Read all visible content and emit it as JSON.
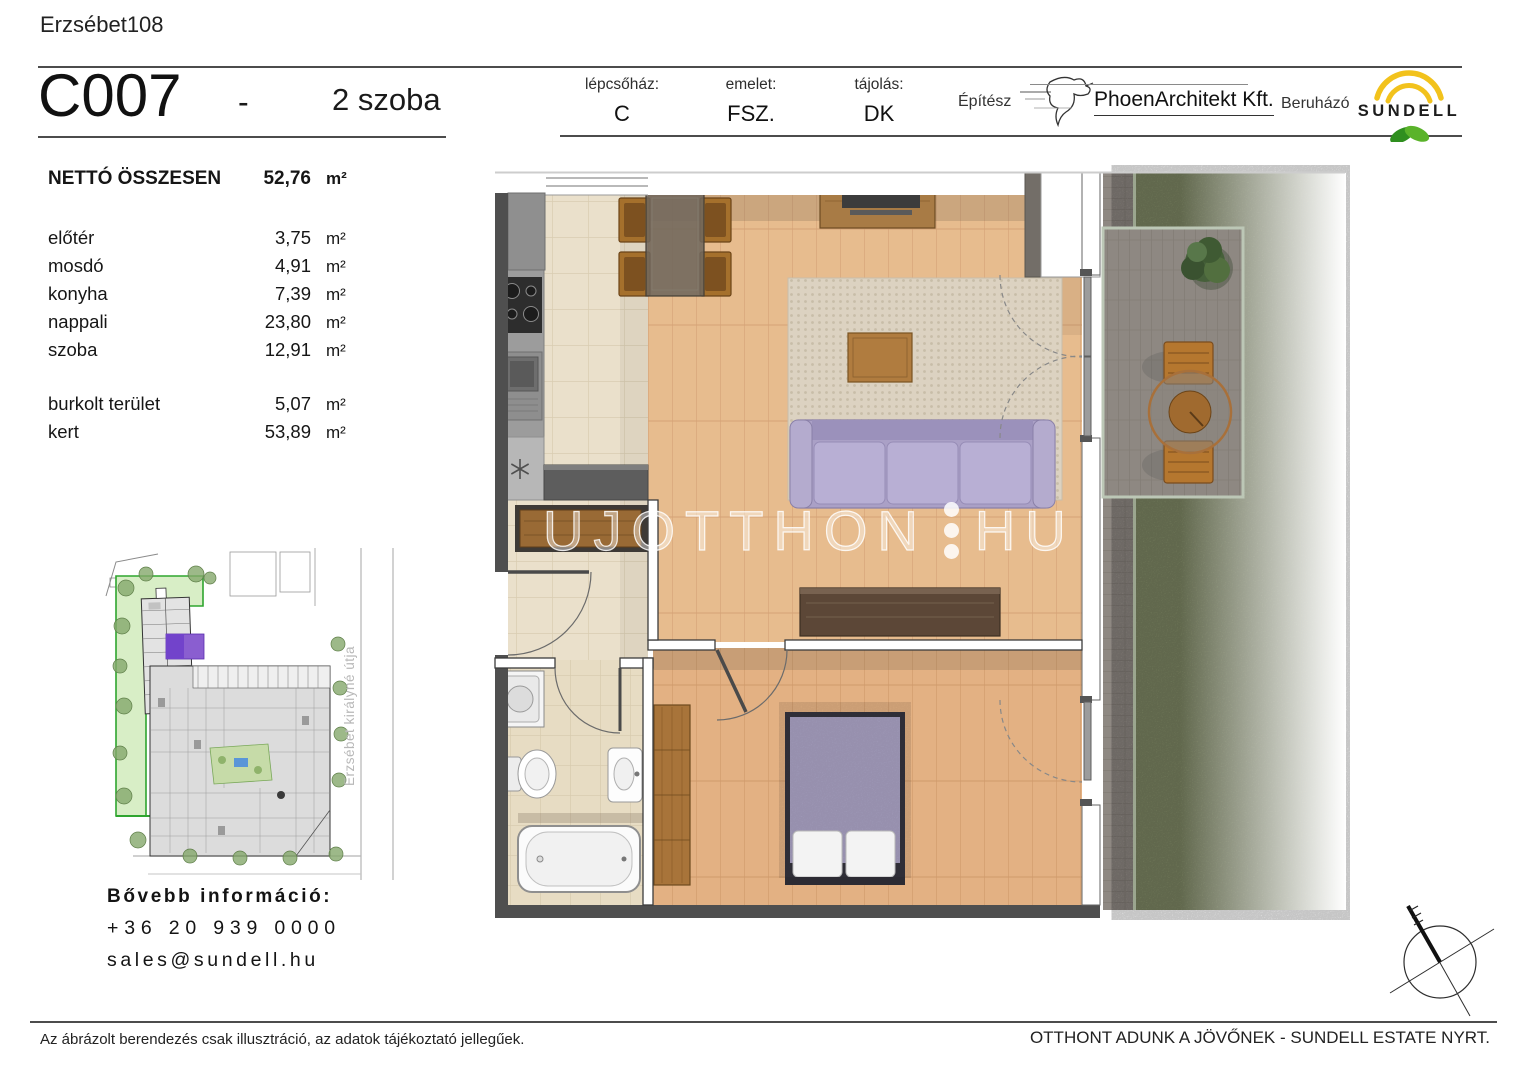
{
  "header": {
    "project_name": "Erzsébet108",
    "unit_id": "C007",
    "separator": "-",
    "room_count": "2 szoba",
    "fields": [
      {
        "label": "lépcsőház:",
        "value": "C"
      },
      {
        "label": "emelet:",
        "value": "FSZ."
      },
      {
        "label": "tájolás:",
        "value": "DK"
      }
    ],
    "architect_label": "Építész",
    "architect_name": "PhoenArchitekt Kft.",
    "developer_label": "Beruházó",
    "developer_name": "SUNDELL"
  },
  "area_table": {
    "total": {
      "label": "NETTÓ ÖSSZESEN",
      "value": "52,76",
      "unit": "m²"
    },
    "rooms": [
      {
        "label": "előtér",
        "value": "3,75",
        "unit": "m²"
      },
      {
        "label": "mosdó",
        "value": "4,91",
        "unit": "m²"
      },
      {
        "label": "konyha",
        "value": "7,39",
        "unit": "m²"
      },
      {
        "label": "nappali",
        "value": "23,80",
        "unit": "m²"
      },
      {
        "label": "szoba",
        "value": "12,91",
        "unit": "m²"
      }
    ],
    "outdoor": [
      {
        "label": "burkolt terület",
        "value": "5,07",
        "unit": "m²"
      },
      {
        "label": "kert",
        "value": "53,89",
        "unit": "m²"
      }
    ]
  },
  "site_map": {
    "street_name": "Erzsébet királyné útja",
    "highlight_color": "#8a5ed0"
  },
  "contact": {
    "title": "Bővebb információ:",
    "phone": "+36 20 939 0000",
    "email": "sales@sundell.hu"
  },
  "watermark": {
    "part1": "UJOTTHON",
    "part2": "HU"
  },
  "footer": {
    "disclaimer": "Az ábrázolt berendezés csak illusztráció, az adatok tájékoztató jellegűek.",
    "slogan": "OTTHONT ADUNK A JÖVŐNEK - SUNDELL ESTATE NYRT."
  },
  "colors": {
    "sun_yellow": "#f2c21c",
    "leaf_green_dark": "#2f8f1f",
    "leaf_green_light": "#5ab32a",
    "grass": "#7e8764",
    "sofa_lavender": "#aaa0c6",
    "wood_floor": "#e7bc8e",
    "tile_floor": "#eae0cb",
    "site_green": "#d8eec6"
  }
}
